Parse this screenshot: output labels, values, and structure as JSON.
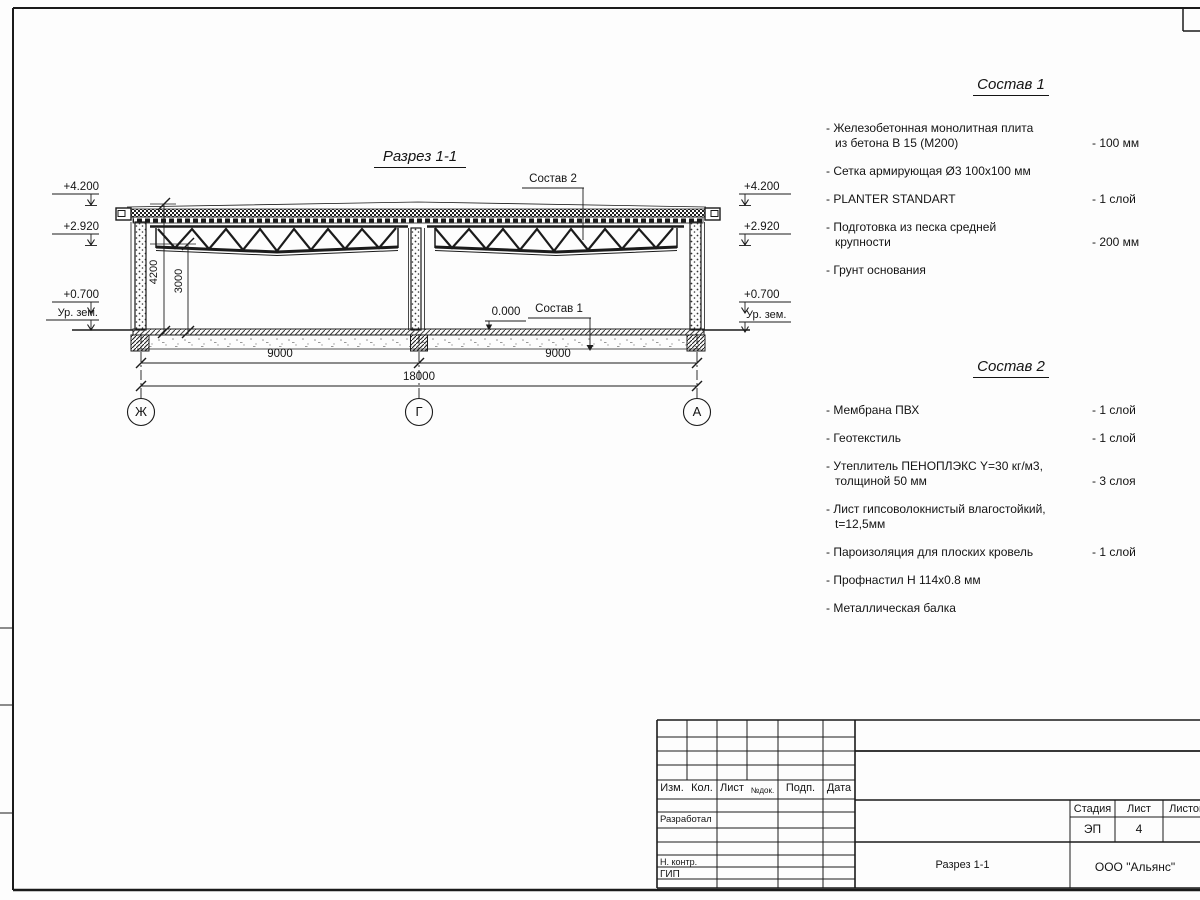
{
  "drawing": {
    "title": "Разрез 1-1",
    "levels": {
      "top": "+4.200",
      "mid": "+2.920",
      "low": "+0.700",
      "ground": "Ур. зем.",
      "zero": "0.000"
    },
    "dims": {
      "height_total": "4200",
      "height_clear": "3000",
      "span1": "9000",
      "span2": "9000",
      "total": "18000"
    },
    "axes": {
      "left": "Ж",
      "center": "Г",
      "right": "А"
    },
    "leaders": {
      "sostav1": "Состав 1",
      "sostav2": "Состав 2"
    }
  },
  "sostav1": {
    "title": "Состав 1",
    "items": [
      {
        "name": "- Железобетонная  монолитная плита\nиз бетона В 15 (М200)",
        "value": "- 100 мм"
      },
      {
        "name": "- Сетка армирующая Ø3 100х100 мм",
        "value": ""
      },
      {
        "name": "- PLANTER STANDART",
        "value": "- 1 слой"
      },
      {
        "name": "- Подготовка из песка средней\nкрупности",
        "value": "- 200 мм"
      },
      {
        "name": "- Грунт основания",
        "value": ""
      }
    ]
  },
  "sostav2": {
    "title": "Состав 2",
    "items": [
      {
        "name": "- Мембрана ПВХ",
        "value": "- 1 слой"
      },
      {
        "name": "- Геотекстиль",
        "value": "- 1 слой"
      },
      {
        "name": "- Утеплитель ПЕНОПЛЭКС Y=30 кг/м3,\nтолщиной 50 мм",
        "value": "- 3 слоя"
      },
      {
        "name": "- Лист гипсоволокнистый влагостойкий,\nt=12,5мм",
        "value": ""
      },
      {
        "name": "- Пароизоляция для плоских кровель",
        "value": "- 1 слой"
      },
      {
        "name": "- Профнастил Н 114х0.8 мм",
        "value": ""
      },
      {
        "name": "- Металлическая балка",
        "value": ""
      }
    ]
  },
  "titleblock": {
    "header_cols": [
      "Изм.",
      "Кол.",
      "Лист",
      "№док.",
      "Подп.",
      "Дата"
    ],
    "row_developed": "Разработал",
    "row_ncontr": "Н. контр.",
    "row_gip": "ГИП",
    "stage_label": "Стадия",
    "sheet_label": "Лист",
    "sheets_label": "Листов",
    "stage_value": "ЭП",
    "sheet_value": "4",
    "doc_title": "Разрез 1-1",
    "company": "ООО \"Альянс\""
  }
}
